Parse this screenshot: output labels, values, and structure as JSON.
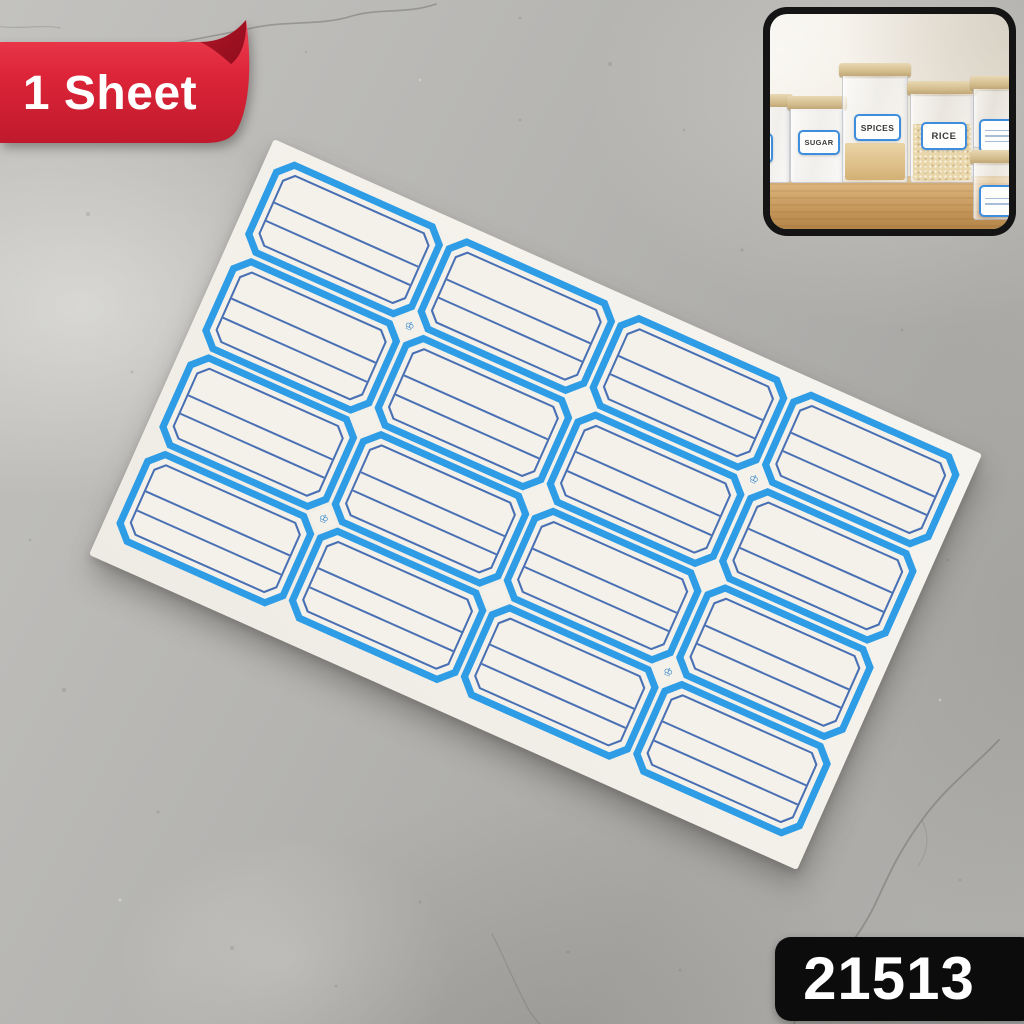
{
  "product": {
    "sheet_badge": "1 Sheet",
    "product_code": "21513"
  },
  "sheet": {
    "rows": 4,
    "cols": 4,
    "label_count": 16,
    "brand_mark": "♔",
    "logo_intersections": [
      [
        1,
        1
      ],
      [
        3,
        1
      ],
      [
        1,
        3
      ],
      [
        3,
        3
      ]
    ]
  },
  "inset": {
    "container_labels": [
      "SUGAR",
      "SPICES",
      "RICE"
    ]
  },
  "colors": {
    "label_border_blue": "#2f9ce6",
    "label_line_blue": "#4a70b4",
    "paper_white": "#f3f1ea",
    "ribbon_red": "#dd2438",
    "badge_black": "#0c0c0c"
  }
}
